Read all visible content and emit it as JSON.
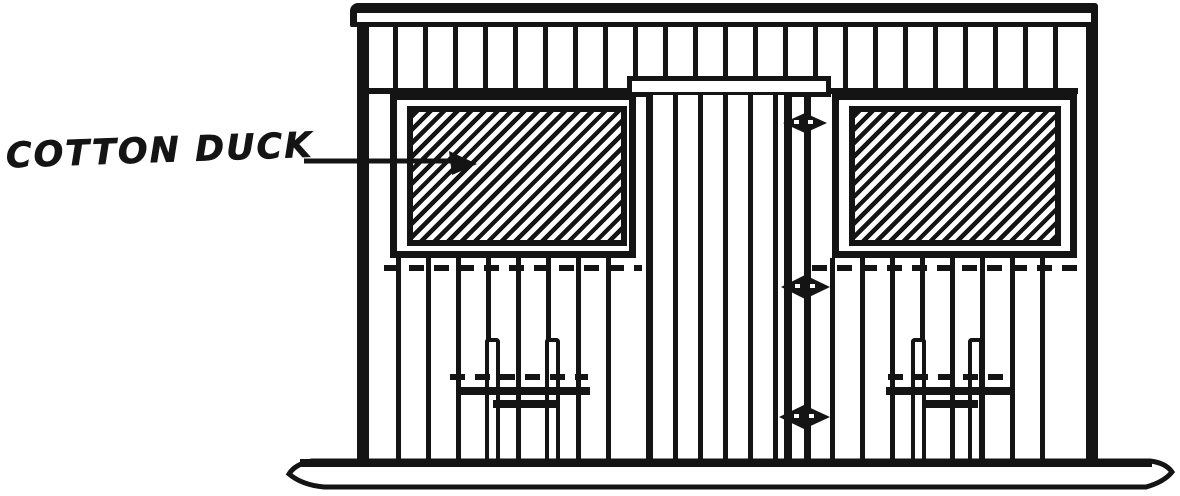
{
  "figure": {
    "caption": {
      "text": "COTTON DUCK"
    },
    "colors": {
      "ink": "#141414",
      "background": "#ffffff"
    },
    "parts": {
      "left_panel": "cotton-duck-curtain-hatched",
      "right_panel": "cotton-duck-curtain-hatched",
      "door": "vertical-board-door",
      "hinge_marks": 3,
      "base": "skid-runner",
      "siding": "vertical-board-siding",
      "hatch_direction": "bottom-left-to-top-right"
    }
  }
}
